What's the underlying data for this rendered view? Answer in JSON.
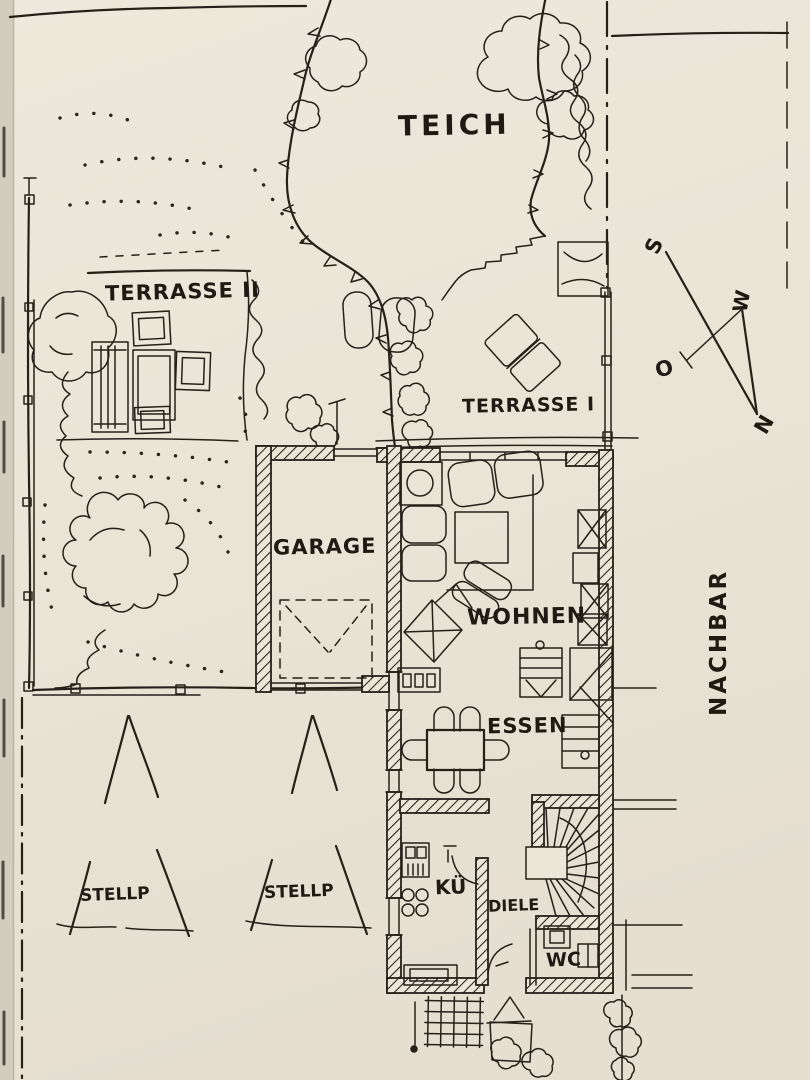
{
  "canvas": {
    "width": 810,
    "height": 1080,
    "paper_color": "#ebe6d8",
    "ink_color": "#262019"
  },
  "plan": {
    "title": "hand-drawn site and floor plan",
    "areas": {
      "pond": "TEICH",
      "terrace2": "TERRASSE II",
      "terrace1": "TERRASSE I",
      "garage": "GARAGE",
      "living": "WOHNEN",
      "dining": "ESSEN",
      "kitchen": "KÜ",
      "hall": "DIELE",
      "wc": "WC",
      "parking1": "STELLP",
      "parking2": "STELLP",
      "neighbor": "NACHBAR"
    },
    "compass": {
      "south": "S",
      "west": "W",
      "east": "O",
      "north": "N"
    }
  }
}
